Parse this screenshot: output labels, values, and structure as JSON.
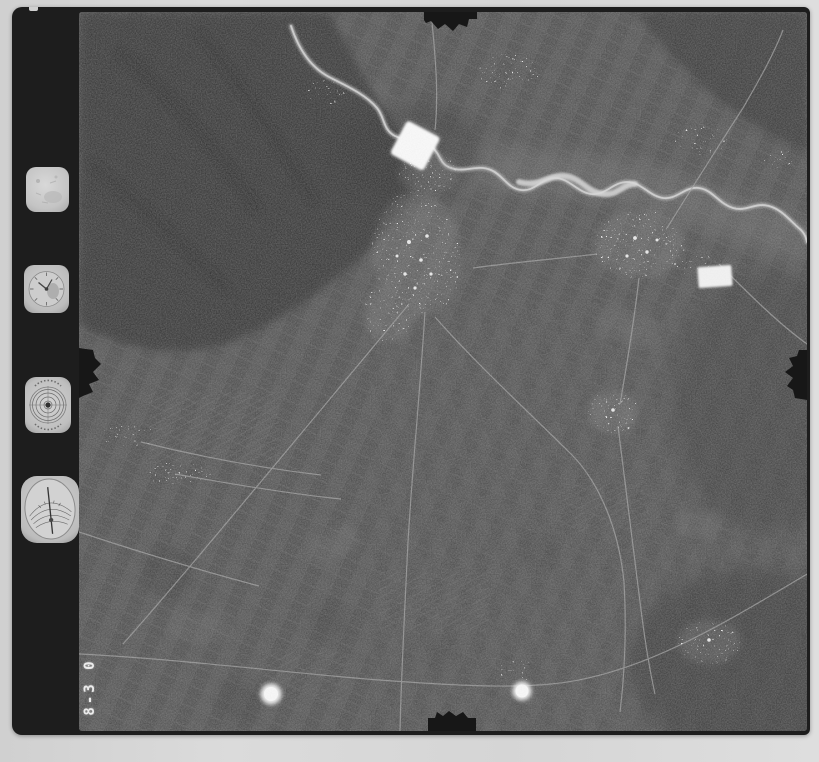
{
  "document": {
    "kind": "black-and-white vertical aerial photograph film frame",
    "frame_counter": "8-3 0"
  },
  "film_margin": {
    "instruments": [
      {
        "icon": "data-window-icon"
      },
      {
        "icon": "watch-dial-icon"
      },
      {
        "icon": "bubble-level-icon"
      },
      {
        "icon": "altimeter-gauge-icon"
      }
    ]
  },
  "photo": {
    "markers": [
      {
        "icon": "white-diamond-marker"
      },
      {
        "icon": "white-rectangle-marker"
      },
      {
        "icon": "registration-dot-left"
      },
      {
        "icon": "registration-dot-right"
      }
    ],
    "edge_marks": [
      {
        "icon": "top-edge-notch"
      },
      {
        "icon": "bottom-edge-notch"
      },
      {
        "icon": "right-edge-notch"
      },
      {
        "icon": "left-edge-notch"
      }
    ]
  },
  "colors": {
    "paper_border": "#d7d7d7",
    "film_black": "#1d1d1d",
    "photo_base": "#4a4a4a",
    "mountain_dark": "#2d2d2d",
    "river_light": "#cfcfcf",
    "marker_white": "#fbfbfb",
    "counter_text": "#ececec"
  }
}
